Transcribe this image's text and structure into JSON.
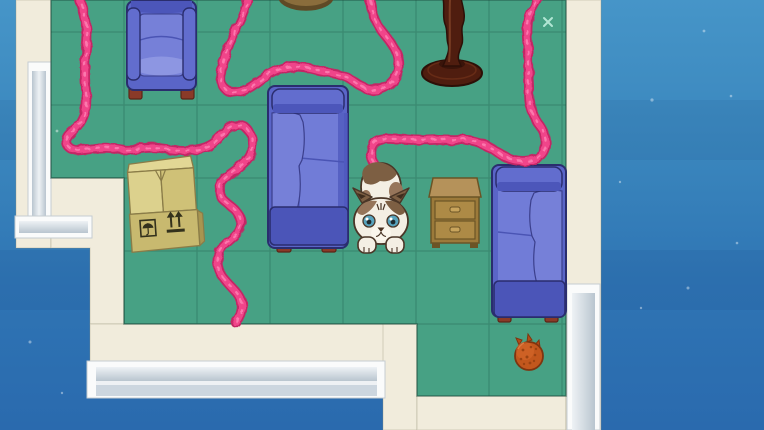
{
  "background": {
    "description": "blue outdoor backdrop",
    "gradient_top": "#4695c8",
    "gradient_bottom": "#2a6aae",
    "sparkles": [
      {
        "x": 652,
        "y": 100,
        "r": 1.6
      },
      {
        "x": 704,
        "y": 31,
        "r": 1.4
      },
      {
        "x": 731,
        "y": 96,
        "r": 1.3
      },
      {
        "x": 688,
        "y": 288,
        "r": 1.5
      },
      {
        "x": 641,
        "y": 308,
        "r": 1.2
      },
      {
        "x": 737,
        "y": 243,
        "r": 1.3
      },
      {
        "x": 620,
        "y": 182,
        "r": 1.2
      },
      {
        "x": 30,
        "y": 342,
        "r": 1.5
      },
      {
        "x": 62,
        "y": 393,
        "r": 1.2
      }
    ]
  },
  "room": {
    "floor_color": "#47a184",
    "grid_color": "rgba(23,70,56,0.25)",
    "floor_edge_color": "rgba(28,74,60,0.55)",
    "wall_color": "#f1ecdc",
    "floor_polygon": "51,0 566,0 566,396 417,396 417,324 124,324 124,178 51,178",
    "floor_sparkle": {
      "transform": "translate(548,22)"
    },
    "floor_dot": {
      "x": 57,
      "y": 131,
      "r": 1.4
    }
  },
  "windows": {
    "frame": "#fafbfb",
    "frame_edge": "#c5cdd2",
    "glass_light": "#eef2f5",
    "glass_dark": "#b9c5cf"
  },
  "yarn": {
    "color": "#f0458a",
    "shadow_color": "#c32765",
    "highlight_color": "#ff8ab8",
    "path": "M78,-6 C84,14 89,28 87,44 C85,60 84,76 86,92 C87,104 86,114 80,123 C74,131 66,134 66,141 C66,148 74,151 82,150 C96,149 104,146 118,149 C132,152 144,146 158,148 C172,150 186,152 199,149 C210,147 216,142 223,134 C229,127 238,122 245,127 C251,132 253,140 252,149 C251,158 244,163 237,169 C229,175 220,180 219,189 C218,198 226,202 233,208 C240,214 243,222 239,230 C235,238 224,243 220,251 C216,259 217,268 222,276 C227,284 236,290 240,298 C244,306 243,314 236,323 M249,-6 C247,6 243,16 238,26 C232,38 226,50 223,62 C220,74 219,86 228,91 C236,95 247,90 255,84 C264,77 273,71 284,68 C295,65 306,67 317,70 C328,73 339,73 348,78 C357,83 363,89 371,90 C380,91 389,86 394,79 C399,72 400,63 397,54 C394,45 387,38 381,30 C375,22 371,12 369,-6 M540,-6 C537,2 532,8 529,16 C527,24 527,34 528,44 C528,58 528,72 529,86 C529,96 529,104 532,112 C535,120 541,126 544,134 C547,142 546,151 540,156 C533,161 523,162 514,160 C505,158 497,152 489,147 C480,142 471,139 461,140 C450,141 440,139 429,140 C418,141 407,139 397,139 C388,139 379,137 374,143 C369,149 370,158 375,165 C378,170 381,173 382,177"
  },
  "palette": {
    "sofa_body": "#5a65c8",
    "sofa_body_mid": "#626dce",
    "sofa_cushion": "#7680d8",
    "sofa_cushion_light": "#8d96e2",
    "sofa_seat": "#717cd7",
    "sofa_dark_band": "#4c56ba",
    "sofa_base": "#4b55b8",
    "sofa_outline": "#2a2d6e",
    "foot": "#8a3a28",
    "foot_edge": "#5c2517",
    "box_flap": "#dcd18d",
    "box_flap_dark": "#cfc177",
    "box_back_edge": "#e2d795",
    "box_front": "#c8b96f",
    "box_side": "#a89550",
    "box_outline": "#8a7c48",
    "box_print": "#33311c",
    "nightstand_top": "#b5925a",
    "nightstand_body": "#9c7a3a",
    "nightstand_drawer": "#ad8a46",
    "nightstand_handle": "#c8a45c",
    "nightstand_outline": "#6b5426",
    "pedestal_wood": "#4f1d0f",
    "pedestal_outline": "#2d0f07",
    "pedestal_highlight": "#8a4a2c",
    "pedestal_foot": "#3a140a",
    "stool_top": "#8a6d3c",
    "stool_edge": "#5f4a26"
  },
  "cat": {
    "fur": "#f4efe4",
    "muzzle": "#faf6ec",
    "patch_dark": "#7d5f43",
    "patch_mid": "#96755a",
    "ear_inner": "#3f2d1e",
    "outline": "#4a3627",
    "eye": "#57a3bd",
    "pupil": "#1d2b30",
    "nose": "#4a3322"
  },
  "ball": {
    "color": "#c2571d",
    "spot": "#9c4312",
    "outline": "#7e3510",
    "tuft": "#b44a16",
    "sheen": "#e8854a"
  }
}
